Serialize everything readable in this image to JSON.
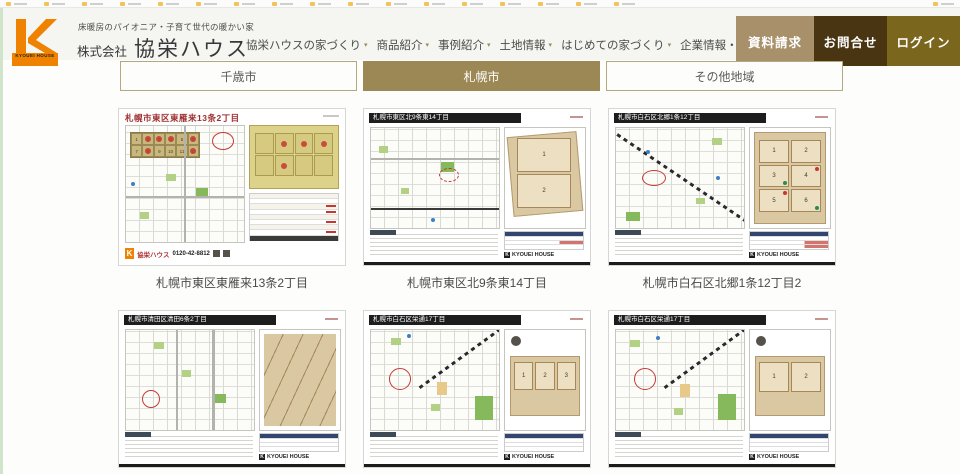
{
  "colors": {
    "gold": "#9c8854",
    "orange": "#ef8200",
    "strip": "#cfe4c9",
    "btn1": "#a7906a",
    "btn2": "#493512",
    "btn3": "#7b661e"
  },
  "icons": {
    "nav_caret": "▾"
  },
  "bookmarks_bar": {
    "item_count": 18
  },
  "header": {
    "logo_letter": "K",
    "logo_text": "KYOUEI HOUSE",
    "tagline": "床暖房のパイオニア・子育て世代の暖かい家",
    "company_prefix": "株式会社",
    "company_name": "協栄ハウス",
    "nav": [
      {
        "label": "協栄ハウスの家づくり"
      },
      {
        "label": "商品紹介"
      },
      {
        "label": "事例紹介"
      },
      {
        "label": "土地情報"
      },
      {
        "label": "はじめての家づくり"
      },
      {
        "label": "企業情報・IR"
      }
    ],
    "buttons": [
      {
        "label": "資料請求"
      },
      {
        "label": "お問合せ"
      },
      {
        "label": "ログイン"
      }
    ]
  },
  "tabs": [
    {
      "label": "千歳市",
      "active": false
    },
    {
      "label": "札幌市",
      "active": true
    },
    {
      "label": "その他地域",
      "active": false
    }
  ],
  "cards": [
    {
      "flyer_title": "札幌市東区東雁来13条2丁目",
      "caption": "札幌市東区東雁来13条2丁目",
      "brand": "協栄ハウス",
      "phone": "0120-42-8812",
      "inset_lots": [
        "1",
        "2",
        "3",
        "4",
        "5",
        "6",
        "7",
        "8",
        "9",
        "10",
        "11",
        "12"
      ]
    },
    {
      "flyer_title": "札幌市東区北9条東14丁目",
      "caption": "札幌市東区北9条東14丁目",
      "brand": "KYOUEI HOUSE",
      "lots": [
        "1",
        "2"
      ]
    },
    {
      "flyer_title": "札幌市白石区北郷1条12丁目",
      "caption": "札幌市白石区北郷1条12丁目2",
      "brand": "KYOUEI HOUSE",
      "lots": [
        "1",
        "2",
        "3",
        "4",
        "5",
        "6"
      ]
    },
    {
      "flyer_title": "札幌市清田区清田6条2丁目",
      "brand": "KYOUEI HOUSE"
    },
    {
      "flyer_title": "札幌市白石区栄通17丁目",
      "brand": "KYOUEI HOUSE",
      "lots": [
        "1",
        "2",
        "3"
      ]
    },
    {
      "flyer_title": "札幌市白石区栄通17丁目",
      "brand": "KYOUEI HOUSE",
      "lots": [
        "1",
        "2"
      ]
    }
  ]
}
